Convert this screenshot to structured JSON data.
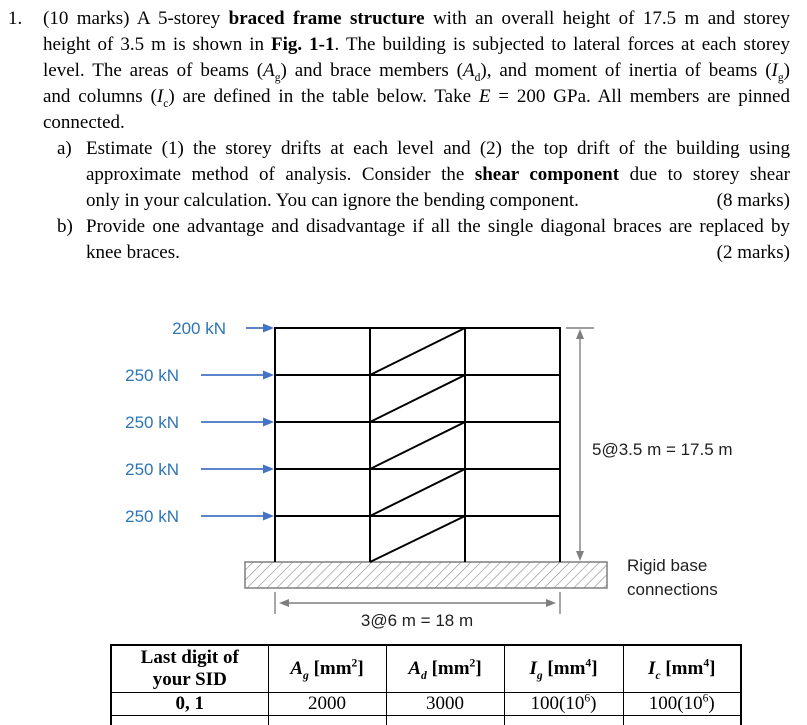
{
  "colors": {
    "force_label": "#2E75B6",
    "force_arrow": "#4472C4",
    "dimension_gray": "#7F7F7F",
    "frame_line": "#000000",
    "body_text": "#000000"
  },
  "problem": {
    "number": "1.",
    "para_lines": [
      [
        {
          "t": "(10 marks) A 5-storey "
        },
        {
          "t": "braced frame structure",
          "b": 1
        },
        {
          "t": " with an overall height of 17.5 m and storey"
        }
      ],
      [
        {
          "t": "height of 3.5 m is shown in "
        },
        {
          "t": "Fig. 1-1",
          "b": 1
        },
        {
          "t": ". The building is subjected to lateral forces at each storey"
        }
      ],
      [
        {
          "t": "level. The areas of beams ("
        },
        {
          "t": "A",
          "i": 1
        },
        {
          "t": "g",
          "sub": 1
        },
        {
          "t": ") and brace members ("
        },
        {
          "t": "A",
          "i": 1
        },
        {
          "t": "d",
          "sub": 1
        },
        {
          "t": "), and moment of inertia of beams ("
        },
        {
          "t": "I",
          "i": 1
        },
        {
          "t": "g",
          "sub": 1
        },
        {
          "t": ")"
        }
      ],
      [
        {
          "t": "and columns ("
        },
        {
          "t": "I",
          "i": 1
        },
        {
          "t": "c",
          "sub": 1
        },
        {
          "t": ") are defined in the table below. Take "
        },
        {
          "t": "E",
          "i": 1
        },
        {
          "t": " = 200 GPa. All members are pinned"
        }
      ],
      [
        {
          "t": "connected."
        }
      ]
    ],
    "items": [
      {
        "label": "a)",
        "lines": [
          [
            {
              "t": "Estimate (1) the storey drifts at each level and (2) the top drift of the building using"
            }
          ],
          [
            {
              "t": "approximate method of analysis. Consider the "
            },
            {
              "t": "shear component",
              "b": 1
            },
            {
              "t": " due to storey shear"
            }
          ]
        ],
        "last_text": [
          {
            "t": "only in your calculation. You can ignore the bending component."
          }
        ],
        "marks": "(8 marks)"
      },
      {
        "label": "b)",
        "lines": [
          [
            {
              "t": "Provide one advantage and disadvantage if all the single diagonal braces are replaced by"
            }
          ]
        ],
        "last_text": [
          {
            "t": "knee braces."
          }
        ],
        "marks": "(2 marks)"
      }
    ]
  },
  "figure": {
    "forces": [
      {
        "label": "200 kN"
      },
      {
        "label": "250 kN"
      },
      {
        "label": "250 kN"
      },
      {
        "label": "250 kN"
      },
      {
        "label": "250 kN"
      }
    ],
    "height_dim_label": "5@3.5 m = 17.5 m",
    "width_dim_label": "3@6 m = 18 m",
    "base_label_1": "Rigid base",
    "base_label_2": "connections"
  },
  "table": {
    "header_sid_line1": "Last digit of",
    "header_sid_line2": "your SID",
    "headers": [
      [
        {
          "t": "A",
          "i": 1
        },
        {
          "t": "g",
          "sub": 1,
          "i": 1
        },
        {
          "t": " [mm"
        },
        {
          "t": "2",
          "sup": 1
        },
        {
          "t": "]"
        }
      ],
      [
        {
          "t": "A",
          "i": 1
        },
        {
          "t": "d",
          "sub": 1,
          "i": 1
        },
        {
          "t": " [mm"
        },
        {
          "t": "2",
          "sup": 1
        },
        {
          "t": "]"
        }
      ],
      [
        {
          "t": "I",
          "i": 1
        },
        {
          "t": "g",
          "sub": 1,
          "i": 1
        },
        {
          "t": " [mm"
        },
        {
          "t": "4",
          "sup": 1
        },
        {
          "t": "]"
        }
      ],
      [
        {
          "t": "I",
          "i": 1
        },
        {
          "t": "c",
          "sub": 1,
          "i": 1
        },
        {
          "t": " [mm"
        },
        {
          "t": "4",
          "sup": 1
        },
        {
          "t": "]"
        }
      ]
    ],
    "rows": [
      {
        "sid": "0, 1",
        "ag": [
          {
            "t": "2000"
          }
        ],
        "ad": [
          {
            "t": "3000"
          }
        ],
        "ig": [
          {
            "t": "100(10"
          },
          {
            "t": "6",
            "sup": 1
          },
          {
            "t": ")"
          }
        ],
        "ic": [
          {
            "t": "100(10"
          },
          {
            "t": "6",
            "sup": 1
          },
          {
            "t": ")"
          }
        ]
      }
    ]
  }
}
